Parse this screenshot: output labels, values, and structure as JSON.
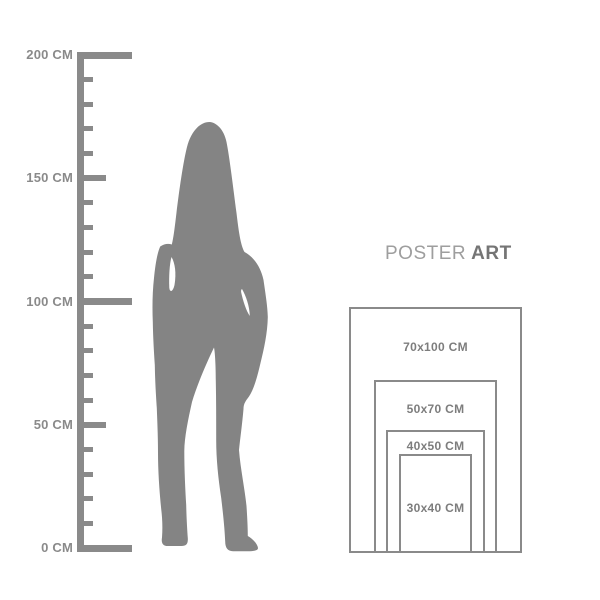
{
  "page": {
    "background": "#ffffff"
  },
  "ruler": {
    "unit": "CM",
    "color": "#8a8a8a",
    "tick_interval_cm": 10,
    "labels": [
      {
        "text": "200 CM",
        "cm": 200
      },
      {
        "text": "150 CM",
        "cm": 150
      },
      {
        "text": "100 CM",
        "cm": 100
      },
      {
        "text": "50 CM",
        "cm": 50
      },
      {
        "text": "0 CM",
        "cm": 0
      }
    ]
  },
  "figure": {
    "description": "standing woman silhouette",
    "color": "#848484"
  },
  "heading": {
    "text_regular": "POSTER",
    "text_bold": "ART"
  },
  "poster_sizes": {
    "border_color": "#8a8a8a",
    "label_color": "#7d7d7d",
    "items": [
      {
        "label": "70x100 CM",
        "width_cm": 70,
        "height_cm": 100
      },
      {
        "label": "50x70 CM",
        "width_cm": 50,
        "height_cm": 70
      },
      {
        "label": "40x50 CM",
        "width_cm": 40,
        "height_cm": 50
      },
      {
        "label": "30x40 CM",
        "width_cm": 30,
        "height_cm": 40
      }
    ]
  }
}
